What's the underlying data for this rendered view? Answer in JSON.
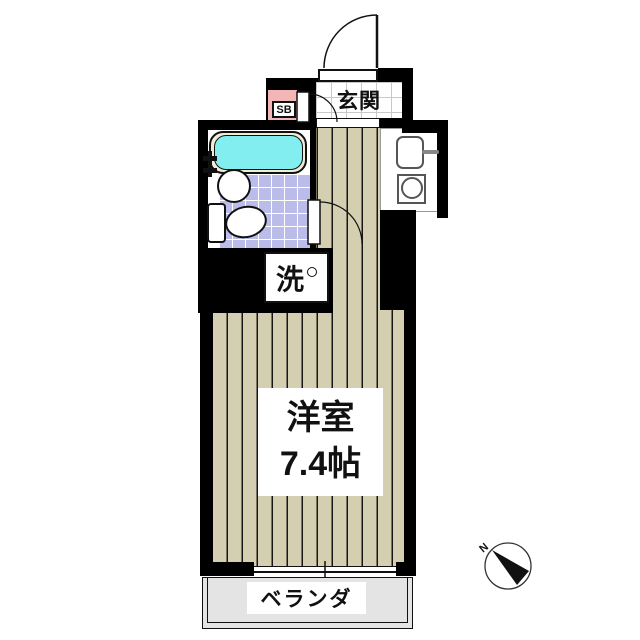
{
  "plan": {
    "labels": {
      "entrance": "玄関",
      "shoe_box": "SB",
      "laundry": "洗",
      "room_name": "洋室",
      "room_size": "7.4帖",
      "balcony": "ベランダ",
      "compass_north": "N"
    },
    "icons": {
      "laundry_tap_icon": "small-circle (water tap mark)",
      "compass_icon": "north-arrow-wedge",
      "door_arcs": "quarter-circle swing paths (entrance, shoe-box side, washroom)"
    },
    "fixtures": {
      "bathroom": [
        "bathtub",
        "round-sink",
        "toilet"
      ],
      "kitchen": [
        "sink-with-faucet",
        "single-burner-stove"
      ]
    },
    "colors": {
      "wall": "#000000",
      "floor_beige": "#d5cfb2",
      "tile_lavender": "#bcbcea",
      "tub_water": "#82eef0",
      "tub_rim": "#f0edd6",
      "shoe_box_pink": "#f2b6b6",
      "balcony_gray": "#e4e4e4",
      "genkan_grid": "#c8c8c8"
    }
  }
}
